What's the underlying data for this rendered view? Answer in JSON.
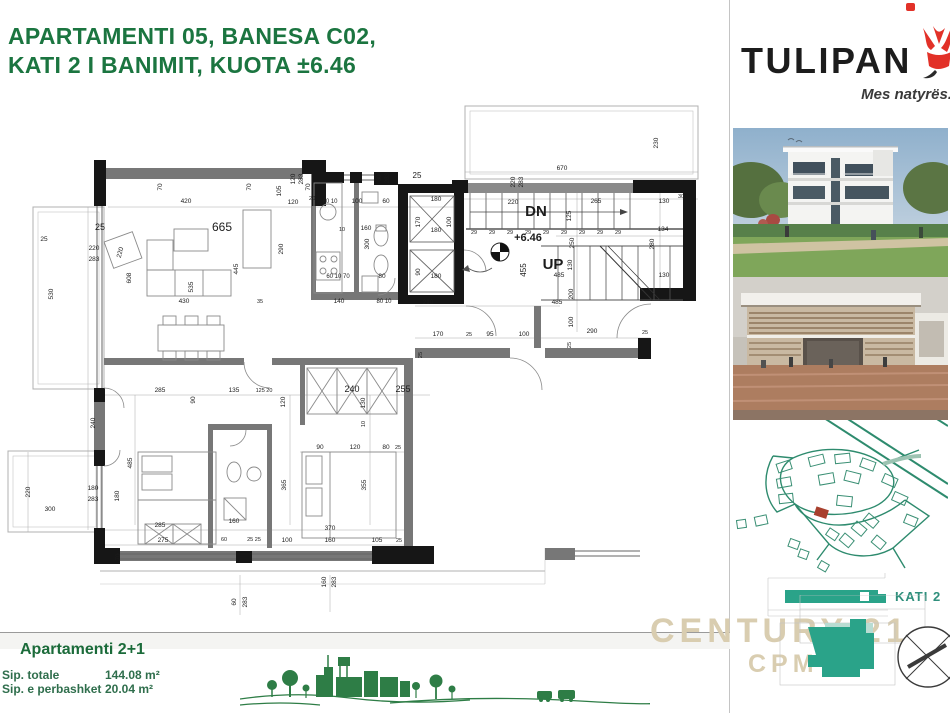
{
  "title": {
    "line1": "APARTAMENTI 05, BANESA C02,",
    "line2": "KATI 2 I BANIMIT, KUOTA ±6.46"
  },
  "brand": {
    "name": "TULIPAN",
    "tagline": "Mes natyrës."
  },
  "info": {
    "heading": "Apartamenti 2+1",
    "rows": [
      {
        "label": "Sip. totale",
        "value": "144.08 m²"
      },
      {
        "label": "Sip. e perbashket",
        "value": "20.04 m²"
      }
    ]
  },
  "floor_badge": {
    "label": "KATI 2"
  },
  "watermark": {
    "line1": "CENTURY 21.",
    "line2": "CPM"
  },
  "colors": {
    "title_green": "#1b7540",
    "teal": "#2aa389",
    "teal_light": "#b9dcd2",
    "watermark_tan": "#d9cdb0",
    "skyline_green": "#2e7d46",
    "tulip_red": "#e23128",
    "sitemap_green": "#2e8b6e",
    "wall_black": "#161616",
    "wall_gray": "#777777"
  },
  "plan": {
    "labels": [
      {
        "t": "670",
        "x": 562,
        "y": 170
      },
      {
        "t": "230",
        "x": 658,
        "y": 143,
        "r": -90
      },
      {
        "t": "220",
        "x": 515,
        "y": 182,
        "r": -90
      },
      {
        "t": "283",
        "x": 523,
        "y": 182,
        "r": -90
      },
      {
        "t": "220",
        "x": 513,
        "y": 204
      },
      {
        "t": "420",
        "x": 186,
        "y": 203
      },
      {
        "t": "70",
        "x": 162,
        "y": 187,
        "r": -90
      },
      {
        "t": "70",
        "x": 251,
        "y": 187,
        "r": -90
      },
      {
        "t": "70",
        "x": 310,
        "y": 187,
        "r": -90
      },
      {
        "t": "105",
        "x": 281,
        "y": 191,
        "r": -90
      },
      {
        "t": "120",
        "x": 295,
        "y": 179,
        "r": -90
      },
      {
        "t": "283",
        "x": 303,
        "y": 179,
        "r": -90
      },
      {
        "t": "120",
        "x": 293,
        "y": 204
      },
      {
        "t": "20",
        "x": 312,
        "y": 200,
        "s": 5.5
      },
      {
        "t": "60",
        "x": 381,
        "y": 178,
        "r": -90
      },
      {
        "t": "283",
        "x": 389,
        "y": 178,
        "r": -90
      },
      {
        "t": "25",
        "x": 417,
        "y": 178,
        "s": 8
      },
      {
        "t": "180",
        "x": 436,
        "y": 201
      },
      {
        "t": "170",
        "x": 420,
        "y": 222,
        "r": -90
      },
      {
        "t": "100",
        "x": 451,
        "y": 222,
        "r": -90
      },
      {
        "t": "180",
        "x": 436,
        "y": 232
      },
      {
        "t": "90",
        "x": 420,
        "y": 272,
        "r": -90
      },
      {
        "t": "180",
        "x": 436,
        "y": 278
      },
      {
        "t": "210",
        "x": 428,
        "y": 304
      },
      {
        "t": "265",
        "x": 596,
        "y": 203
      },
      {
        "t": "130",
        "x": 664,
        "y": 203
      },
      {
        "t": "30",
        "x": 681,
        "y": 198,
        "s": 5.5
      },
      {
        "t": "125",
        "x": 571,
        "y": 216,
        "r": -90
      },
      {
        "t": "134",
        "x": 663,
        "y": 231
      },
      {
        "t": "280",
        "x": 654,
        "y": 244,
        "r": -90
      },
      {
        "t": "250",
        "x": 574,
        "y": 243,
        "r": -90
      },
      {
        "t": "130",
        "x": 572,
        "y": 265,
        "r": -90
      },
      {
        "t": "485",
        "x": 559,
        "y": 277
      },
      {
        "t": "130",
        "x": 664,
        "y": 277
      },
      {
        "t": "200",
        "x": 573,
        "y": 294,
        "r": -90
      },
      {
        "t": "485",
        "x": 557,
        "y": 304
      },
      {
        "t": "100",
        "x": 573,
        "y": 322,
        "r": -90
      },
      {
        "t": "290",
        "x": 592,
        "y": 333
      },
      {
        "t": "25",
        "x": 645,
        "y": 334,
        "s": 5.5
      },
      {
        "t": "DN",
        "x": 536,
        "y": 216,
        "s": 15,
        "w": 600
      },
      {
        "t": "UP",
        "x": 553,
        "y": 269,
        "s": 15,
        "w": 600
      },
      {
        "t": "+6.46",
        "x": 528,
        "y": 241,
        "s": 11,
        "w": 600
      },
      {
        "t": "455",
        "x": 526,
        "y": 270,
        "r": -90,
        "s": 8
      },
      {
        "t": "29",
        "x": 474,
        "y": 234,
        "s": 5.5
      },
      {
        "t": "29",
        "x": 492,
        "y": 234,
        "s": 5.5
      },
      {
        "t": "29",
        "x": 510,
        "y": 234,
        "s": 5.5
      },
      {
        "t": "29",
        "x": 528,
        "y": 234,
        "s": 5.5
      },
      {
        "t": "29",
        "x": 546,
        "y": 234,
        "s": 5.5
      },
      {
        "t": "29",
        "x": 564,
        "y": 234,
        "s": 5.5
      },
      {
        "t": "29",
        "x": 582,
        "y": 234,
        "s": 5.5
      },
      {
        "t": "29",
        "x": 600,
        "y": 234,
        "s": 5.5
      },
      {
        "t": "29",
        "x": 618,
        "y": 234,
        "s": 5.5
      },
      {
        "t": "665",
        "x": 222,
        "y": 231,
        "s": 12
      },
      {
        "t": "290",
        "x": 283,
        "y": 249,
        "r": -90
      },
      {
        "t": "445",
        "x": 238,
        "y": 269,
        "r": -90
      },
      {
        "t": "535",
        "x": 193,
        "y": 287,
        "r": -90
      },
      {
        "t": "430",
        "x": 184,
        "y": 303
      },
      {
        "t": "35",
        "x": 260,
        "y": 303,
        "s": 5.5
      },
      {
        "t": "608",
        "x": 131,
        "y": 278,
        "r": -90
      },
      {
        "t": "220",
        "x": 122,
        "y": 253,
        "r": -75
      },
      {
        "t": "25",
        "x": 100,
        "y": 230,
        "s": 9
      },
      {
        "t": "530",
        "x": 53,
        "y": 294,
        "r": -90
      },
      {
        "t": "220",
        "x": 94,
        "y": 250
      },
      {
        "t": "283",
        "x": 94,
        "y": 261
      },
      {
        "t": "25",
        "x": 44,
        "y": 241
      },
      {
        "t": "220",
        "x": 30,
        "y": 492,
        "r": -90
      },
      {
        "t": "180",
        "x": 93,
        "y": 490
      },
      {
        "t": "283",
        "x": 93,
        "y": 501
      },
      {
        "t": "300",
        "x": 50,
        "y": 511
      },
      {
        "t": "60 10",
        "x": 330,
        "y": 203,
        "s": 6
      },
      {
        "t": "100",
        "x": 357,
        "y": 203
      },
      {
        "t": "60",
        "x": 386,
        "y": 203
      },
      {
        "t": "160",
        "x": 366,
        "y": 230
      },
      {
        "t": "10",
        "x": 342,
        "y": 231,
        "s": 5.5
      },
      {
        "t": "300",
        "x": 369,
        "y": 244,
        "r": -90
      },
      {
        "t": "60 10 70",
        "x": 338,
        "y": 278,
        "s": 6
      },
      {
        "t": "80",
        "x": 382,
        "y": 278
      },
      {
        "t": "140",
        "x": 339,
        "y": 303
      },
      {
        "t": "80 10",
        "x": 384,
        "y": 303,
        "s": 6
      },
      {
        "t": "285",
        "x": 160,
        "y": 392
      },
      {
        "t": "135",
        "x": 234,
        "y": 392
      },
      {
        "t": "125 20",
        "x": 264,
        "y": 392,
        "s": 5.5
      },
      {
        "t": "90",
        "x": 195,
        "y": 400,
        "r": -90
      },
      {
        "t": "240",
        "x": 352,
        "y": 392,
        "s": 9
      },
      {
        "t": "255",
        "x": 403,
        "y": 392,
        "s": 9
      },
      {
        "t": "120",
        "x": 285,
        "y": 402,
        "r": -90
      },
      {
        "t": "130",
        "x": 365,
        "y": 403,
        "r": -90
      },
      {
        "t": "10",
        "x": 365,
        "y": 424,
        "r": -90,
        "s": 5.5
      },
      {
        "t": "90",
        "x": 320,
        "y": 449
      },
      {
        "t": "120",
        "x": 355,
        "y": 449
      },
      {
        "t": "80",
        "x": 386,
        "y": 449
      },
      {
        "t": "25",
        "x": 398,
        "y": 449,
        "s": 5.5
      },
      {
        "t": "365",
        "x": 286,
        "y": 485,
        "r": -90
      },
      {
        "t": "355",
        "x": 366,
        "y": 485,
        "r": -90
      },
      {
        "t": "240",
        "x": 95,
        "y": 423,
        "r": -90
      },
      {
        "t": "485",
        "x": 132,
        "y": 463,
        "r": -90
      },
      {
        "t": "180",
        "x": 119,
        "y": 496,
        "r": -90
      },
      {
        "t": "170",
        "x": 438,
        "y": 336
      },
      {
        "t": "25",
        "x": 469,
        "y": 336,
        "s": 5.5
      },
      {
        "t": "95",
        "x": 490,
        "y": 336
      },
      {
        "t": "100",
        "x": 524,
        "y": 336
      },
      {
        "t": "25",
        "x": 422,
        "y": 355,
        "r": -90,
        "s": 5.5
      },
      {
        "t": "25",
        "x": 571,
        "y": 345,
        "r": -90,
        "s": 5.5
      },
      {
        "t": "285",
        "x": 160,
        "y": 527
      },
      {
        "t": "275",
        "x": 163,
        "y": 542
      },
      {
        "t": "160",
        "x": 234,
        "y": 523
      },
      {
        "t": "60",
        "x": 224,
        "y": 541,
        "s": 5.5
      },
      {
        "t": "25 25",
        "x": 254,
        "y": 541,
        "s": 5.5
      },
      {
        "t": "370",
        "x": 330,
        "y": 530
      },
      {
        "t": "100",
        "x": 287,
        "y": 542
      },
      {
        "t": "160",
        "x": 330,
        "y": 542
      },
      {
        "t": "105",
        "x": 377,
        "y": 542
      },
      {
        "t": "25",
        "x": 399,
        "y": 542,
        "s": 5.5
      },
      {
        "t": "60",
        "x": 236,
        "y": 602,
        "r": -90
      },
      {
        "t": "283",
        "x": 247,
        "y": 602,
        "r": -90
      },
      {
        "t": "160",
        "x": 326,
        "y": 582,
        "r": -90
      },
      {
        "t": "283",
        "x": 336,
        "y": 582,
        "r": -90
      },
      {
        "t": "70",
        "x": 120,
        "y": 557,
        "r": -90
      }
    ]
  }
}
